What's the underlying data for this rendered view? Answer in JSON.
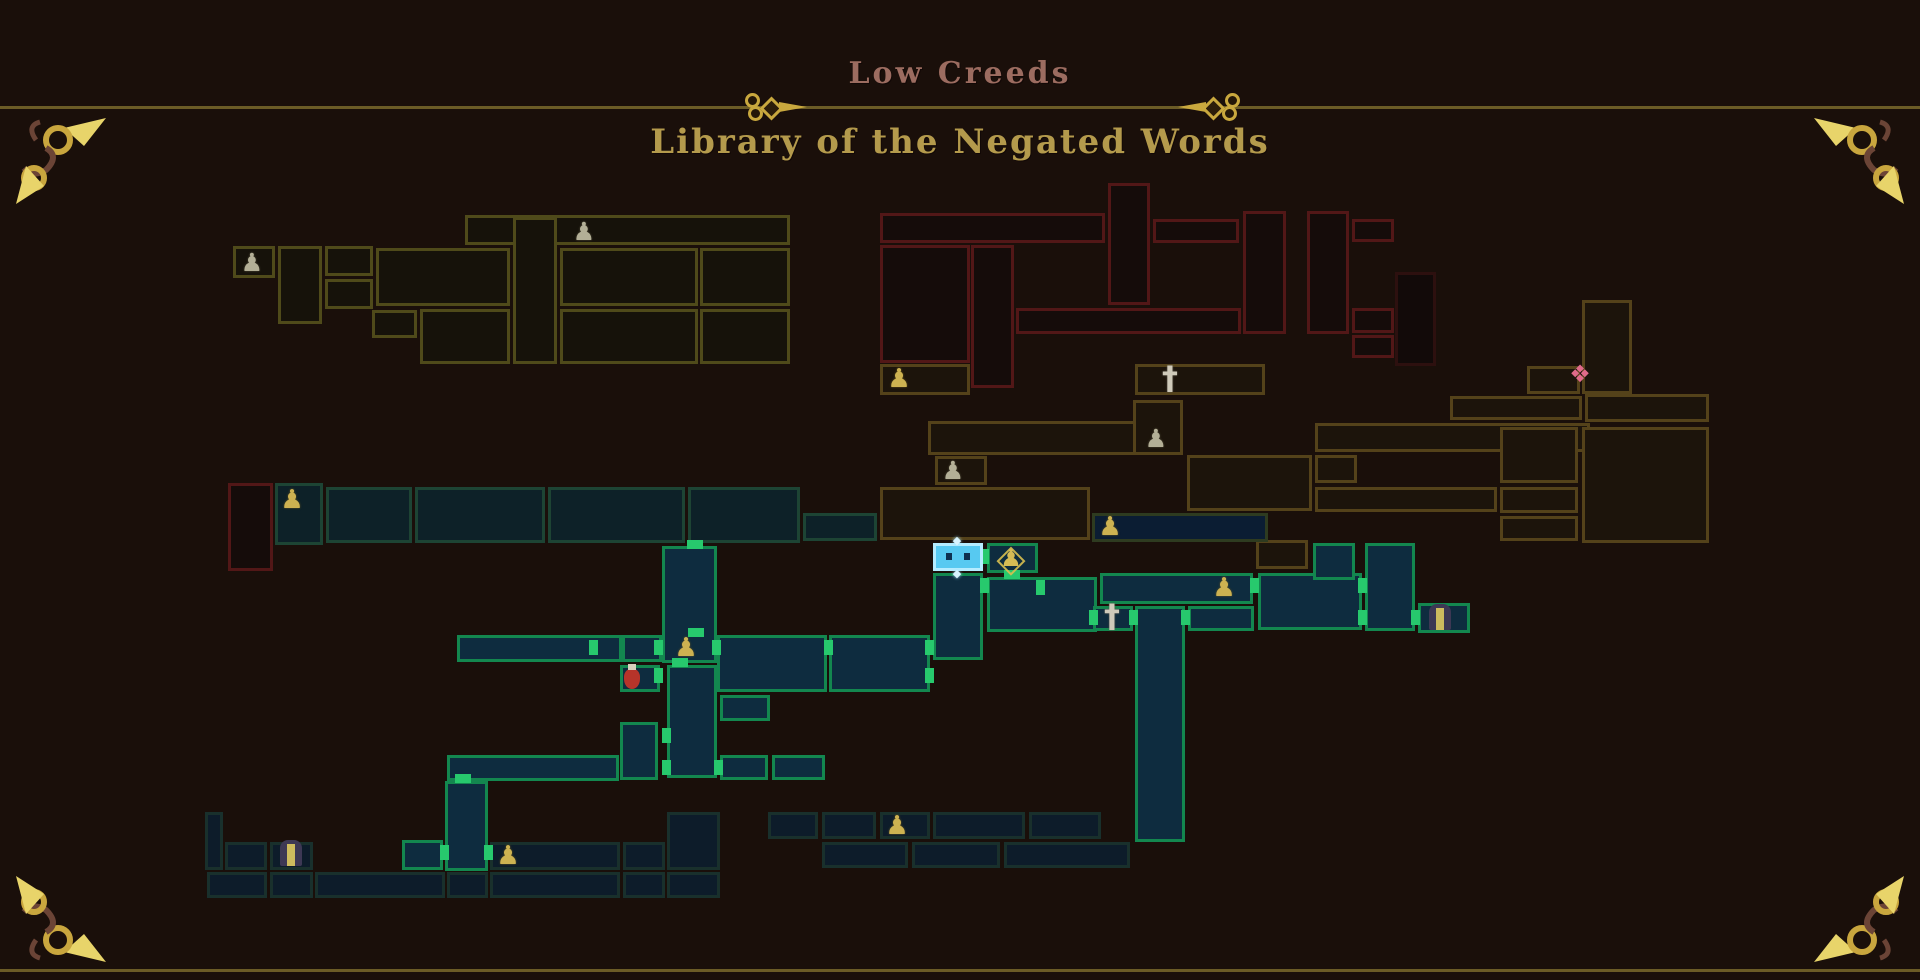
{
  "header": {
    "area_title": "Low Creeds",
    "zone_title": "Library of the Negated Words"
  },
  "palette": {
    "background": "#1a0f0a",
    "frame_line": "#6b5b26",
    "ornament_gold": "#c9a83e",
    "flourish_gold": "#e8d46a",
    "flourish_brown": "#6b4436",
    "area_title_color": "#9c6c60",
    "zone_title_color": "#b49a4c",
    "player_fill": "#57c9f1",
    "player_border": "#b5ecff",
    "current_zone_border": "#13874f",
    "current_zone_fill": "#0e2c3f",
    "door_marker": "#27c96d",
    "zone_olive_border": "#4f4a1a",
    "zone_red_border": "#521717",
    "zone_brown_border": "#54421a",
    "zone_teal_dim_border": "#1d4434",
    "zone_navy_border": "#19302c",
    "icon_gold": "#cdb251",
    "icon_silver": "#b3af96",
    "flask_red": "#b6342a",
    "gate_purple": "#3d3854",
    "diamond_pink": "#e06a8a"
  },
  "map": {
    "rooms": [
      [
        465,
        215,
        325,
        30,
        "o"
      ],
      [
        233,
        246,
        42,
        32,
        "o"
      ],
      [
        278,
        246,
        44,
        78,
        "o"
      ],
      [
        325,
        246,
        48,
        30,
        "o"
      ],
      [
        325,
        279,
        48,
        30,
        "o"
      ],
      [
        376,
        248,
        134,
        58,
        "o"
      ],
      [
        513,
        217,
        44,
        147,
        "o"
      ],
      [
        560,
        248,
        138,
        58,
        "o"
      ],
      [
        700,
        248,
        90,
        58,
        "o"
      ],
      [
        372,
        310,
        45,
        28,
        "o"
      ],
      [
        420,
        309,
        90,
        55,
        "o"
      ],
      [
        560,
        309,
        138,
        55,
        "o"
      ],
      [
        700,
        309,
        90,
        55,
        "o"
      ],
      [
        880,
        213,
        225,
        30,
        "r"
      ],
      [
        1108,
        183,
        42,
        122,
        "r"
      ],
      [
        1153,
        219,
        86,
        24,
        "r"
      ],
      [
        880,
        245,
        90,
        118,
        "r"
      ],
      [
        971,
        245,
        43,
        143,
        "r"
      ],
      [
        1016,
        308,
        225,
        26,
        "r"
      ],
      [
        1243,
        211,
        43,
        123,
        "r"
      ],
      [
        1307,
        211,
        42,
        123,
        "r"
      ],
      [
        1352,
        219,
        42,
        23,
        "r"
      ],
      [
        1352,
        308,
        42,
        25,
        "r"
      ],
      [
        1352,
        335,
        42,
        23,
        "r"
      ],
      [
        1395,
        272,
        41,
        94,
        "rd"
      ],
      [
        228,
        483,
        45,
        88,
        "r"
      ],
      [
        880,
        364,
        90,
        31,
        "b"
      ],
      [
        1135,
        364,
        130,
        31,
        "b"
      ],
      [
        928,
        421,
        220,
        34,
        "b"
      ],
      [
        1133,
        400,
        50,
        55,
        "b"
      ],
      [
        935,
        456,
        52,
        29,
        "b"
      ],
      [
        880,
        487,
        210,
        53,
        "b"
      ],
      [
        1187,
        455,
        125,
        56,
        "b"
      ],
      [
        1315,
        423,
        275,
        29,
        "b"
      ],
      [
        1315,
        455,
        42,
        28,
        "b"
      ],
      [
        1315,
        487,
        182,
        25,
        "b"
      ],
      [
        1450,
        396,
        132,
        24,
        "b"
      ],
      [
        1527,
        366,
        53,
        28,
        "b"
      ],
      [
        1582,
        300,
        50,
        94,
        "b"
      ],
      [
        1585,
        394,
        124,
        28,
        "b"
      ],
      [
        1582,
        427,
        127,
        116,
        "b"
      ],
      [
        1500,
        427,
        78,
        56,
        "b"
      ],
      [
        1500,
        487,
        78,
        26,
        "b"
      ],
      [
        1500,
        516,
        78,
        25,
        "b"
      ],
      [
        1256,
        540,
        52,
        29,
        "b"
      ],
      [
        1092,
        513,
        176,
        29,
        "nb"
      ],
      [
        275,
        483,
        48,
        62,
        "td"
      ],
      [
        326,
        487,
        86,
        56,
        "td"
      ],
      [
        415,
        487,
        130,
        56,
        "td"
      ],
      [
        548,
        487,
        137,
        56,
        "td"
      ],
      [
        688,
        487,
        112,
        56,
        "td"
      ],
      [
        803,
        513,
        74,
        28,
        "td"
      ],
      [
        457,
        635,
        165,
        27,
        "t"
      ],
      [
        622,
        635,
        40,
        27,
        "t"
      ],
      [
        662,
        546,
        55,
        117,
        "t"
      ],
      [
        717,
        635,
        110,
        57,
        "t"
      ],
      [
        829,
        635,
        101,
        57,
        "t"
      ],
      [
        620,
        665,
        40,
        27,
        "t"
      ],
      [
        620,
        722,
        38,
        58,
        "t"
      ],
      [
        667,
        665,
        50,
        113,
        "t"
      ],
      [
        720,
        695,
        50,
        26,
        "t"
      ],
      [
        720,
        755,
        48,
        25,
        "t"
      ],
      [
        772,
        755,
        53,
        25,
        "t"
      ],
      [
        447,
        755,
        172,
        26,
        "t"
      ],
      [
        445,
        781,
        43,
        90,
        "t"
      ],
      [
        402,
        840,
        41,
        30,
        "t"
      ],
      [
        933,
        573,
        50,
        87,
        "t"
      ],
      [
        987,
        543,
        51,
        30,
        "t"
      ],
      [
        987,
        577,
        110,
        55,
        "t"
      ],
      [
        1100,
        573,
        153,
        31,
        "t"
      ],
      [
        1258,
        573,
        104,
        57,
        "t"
      ],
      [
        1093,
        606,
        40,
        25,
        "t"
      ],
      [
        1135,
        606,
        50,
        236,
        "t"
      ],
      [
        1188,
        606,
        66,
        25,
        "t"
      ],
      [
        1313,
        543,
        42,
        37,
        "t"
      ],
      [
        1365,
        543,
        50,
        88,
        "t"
      ],
      [
        1418,
        603,
        52,
        30,
        "t"
      ],
      [
        933,
        543,
        50,
        28,
        "p"
      ],
      [
        205,
        812,
        18,
        58,
        "n"
      ],
      [
        225,
        842,
        42,
        28,
        "n"
      ],
      [
        270,
        842,
        43,
        28,
        "n"
      ],
      [
        490,
        842,
        130,
        28,
        "n"
      ],
      [
        623,
        842,
        42,
        28,
        "n"
      ],
      [
        667,
        812,
        53,
        58,
        "n"
      ],
      [
        207,
        872,
        60,
        26,
        "n"
      ],
      [
        270,
        872,
        43,
        26,
        "n"
      ],
      [
        315,
        872,
        130,
        26,
        "n"
      ],
      [
        447,
        872,
        41,
        26,
        "n"
      ],
      [
        490,
        872,
        130,
        26,
        "n"
      ],
      [
        623,
        872,
        42,
        26,
        "n"
      ],
      [
        667,
        872,
        53,
        26,
        "n"
      ],
      [
        768,
        812,
        50,
        27,
        "n"
      ],
      [
        822,
        812,
        54,
        27,
        "n"
      ],
      [
        880,
        812,
        50,
        27,
        "n"
      ],
      [
        933,
        812,
        92,
        27,
        "n"
      ],
      [
        1029,
        812,
        72,
        27,
        "n"
      ],
      [
        822,
        842,
        86,
        26,
        "n"
      ],
      [
        912,
        842,
        88,
        26,
        "n"
      ],
      [
        1004,
        842,
        126,
        26,
        "n"
      ]
    ],
    "doors": [
      [
        654,
        640,
        9,
        15
      ],
      [
        654,
        668,
        9,
        15
      ],
      [
        712,
        640,
        9,
        15
      ],
      [
        824,
        640,
        9,
        15
      ],
      [
        925,
        640,
        9,
        15
      ],
      [
        925,
        668,
        9,
        15
      ],
      [
        980,
        549,
        9,
        15
      ],
      [
        980,
        578,
        9,
        15
      ],
      [
        1036,
        580,
        9,
        15
      ],
      [
        1089,
        610,
        9,
        15
      ],
      [
        1129,
        610,
        9,
        15
      ],
      [
        1181,
        610,
        9,
        15
      ],
      [
        1250,
        578,
        9,
        15
      ],
      [
        1358,
        578,
        9,
        15
      ],
      [
        1358,
        610,
        9,
        15
      ],
      [
        1411,
        610,
        9,
        15
      ],
      [
        589,
        640,
        9,
        15
      ],
      [
        440,
        845,
        9,
        15
      ],
      [
        484,
        845,
        9,
        15
      ],
      [
        662,
        728,
        9,
        15
      ],
      [
        662,
        760,
        9,
        15
      ],
      [
        714,
        760,
        9,
        15
      ],
      [
        672,
        658,
        16,
        9
      ],
      [
        688,
        628,
        16,
        9
      ],
      [
        1004,
        570,
        16,
        9
      ],
      [
        455,
        774,
        16,
        9
      ],
      [
        687,
        540,
        16,
        9
      ]
    ],
    "icons": [
      [
        "lantern-silver",
        584,
        231
      ],
      [
        "lantern-silver",
        252,
        262
      ],
      [
        "lantern-silver",
        1156,
        438
      ],
      [
        "lantern-silver",
        953,
        470
      ],
      [
        "lantern-gold",
        899,
        379
      ],
      [
        "lantern-gold",
        292,
        500
      ],
      [
        "lantern-gold",
        1110,
        527
      ],
      [
        "lantern-gold",
        686,
        648
      ],
      [
        "lantern-gold",
        1224,
        588
      ],
      [
        "lantern-gold",
        508,
        856
      ],
      [
        "lantern-gold",
        897,
        826
      ],
      [
        "lantern-sparkle",
        1011,
        558
      ],
      [
        "sword",
        1170,
        378
      ],
      [
        "sword",
        1112,
        616
      ],
      [
        "flask",
        632,
        677
      ],
      [
        "diamond-pink",
        1580,
        374
      ],
      [
        "gate",
        1440,
        617
      ],
      [
        "gate",
        291,
        853
      ],
      [
        "diamond-white",
        957,
        540
      ],
      [
        "diamond-white",
        957,
        573
      ]
    ]
  }
}
